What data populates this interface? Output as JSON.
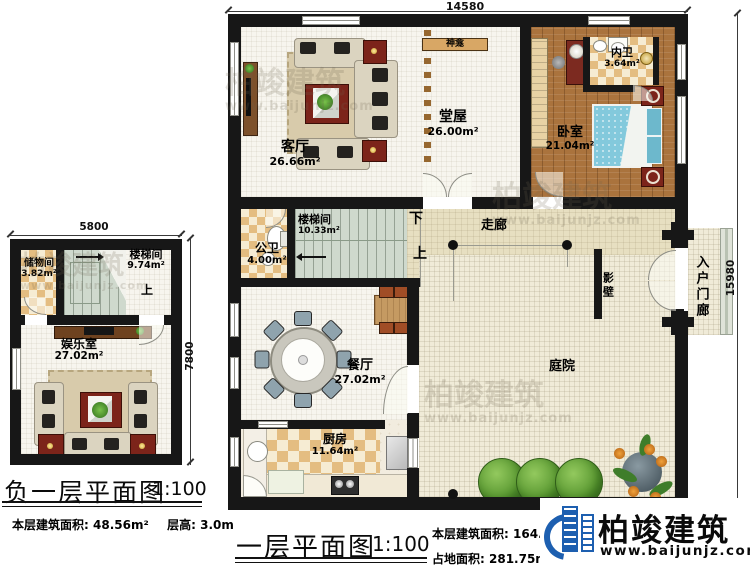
{
  "watermark": {
    "brand": "柏竣建筑",
    "url": "www.baijunjz.com"
  },
  "logo": {
    "brand": "柏竣建筑",
    "url": "www.baijunjz.com"
  },
  "floor1": {
    "title": "一层平面图",
    "scale": "1:100",
    "dim_top": "14580",
    "dim_right": "15980",
    "stats": {
      "area_label": "本层建筑面积:",
      "area": "164.92m²",
      "land_label": "占地面积:",
      "land": "281.75m²",
      "height_label": "层高:",
      "height": "3.9m"
    },
    "rooms": {
      "keting": {
        "name": "客厅",
        "area": "26.66m²"
      },
      "tangwu": {
        "name": "堂屋",
        "area": "26.00m²"
      },
      "shenkan": {
        "name": "神龛"
      },
      "neiwei": {
        "name": "内卫",
        "area": "3.64m²"
      },
      "woshi": {
        "name": "卧室",
        "area": "21.04m²"
      },
      "loutijian": {
        "name": "楼梯间",
        "area": "10.33m²"
      },
      "gongwei": {
        "name": "公卫",
        "area": "4.00m²"
      },
      "zoulang": {
        "name": "走廊"
      },
      "yingbi": {
        "name": "影壁"
      },
      "rumenlang": {
        "name": "入户门廊"
      },
      "canting": {
        "name": "餐厅",
        "area": "27.02m²"
      },
      "chufang": {
        "name": "厨房",
        "area": "11.64m²"
      },
      "tingyuan": {
        "name": "庭院"
      }
    },
    "stair": {
      "down": "下",
      "up": "上"
    }
  },
  "basement": {
    "title": "负一层平面图",
    "scale": "1:100",
    "dim_top": "5800",
    "dim_right": "7800",
    "stats": {
      "area_label": "本层建筑面积:",
      "area": "48.56m²",
      "height_label": "层高:",
      "height": "3.0m"
    },
    "rooms": {
      "chuwujian": {
        "name": "储物间",
        "area": "3.82m²"
      },
      "loutijian": {
        "name": "楼梯间",
        "area": "9.74m²"
      },
      "yuleshi": {
        "name": "娱乐室",
        "area": "27.02m²"
      }
    },
    "stair": {
      "up": "上"
    }
  }
}
